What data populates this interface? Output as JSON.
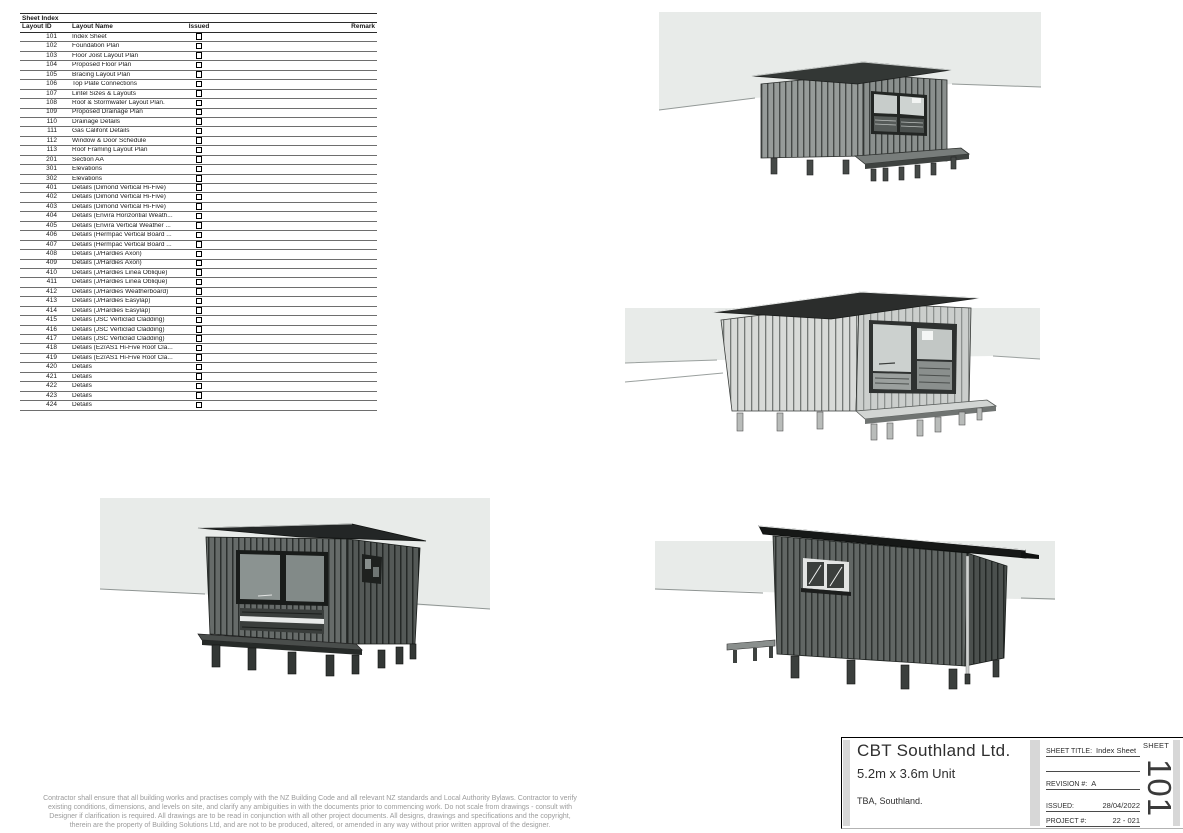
{
  "colors": {
    "sky_band": "#e8ebe9",
    "table_rule": "#6e6e6e",
    "divider_gray": "#d7d7d7",
    "disclaimer_text": "#9b9b9b",
    "ink": "#1a1a1a"
  },
  "sheet_index": {
    "title": "Sheet Index",
    "columns": [
      "Layout ID",
      "Layout Name",
      "Issued",
      "Remark"
    ],
    "rows": [
      {
        "layout_id": "101",
        "layout_name": "Index Sheet",
        "issued": false,
        "remark": ""
      },
      {
        "layout_id": "102",
        "layout_name": "Foundation Plan",
        "issued": false,
        "remark": ""
      },
      {
        "layout_id": "103",
        "layout_name": "Floor Joist Layout Plan",
        "issued": false,
        "remark": ""
      },
      {
        "layout_id": "104",
        "layout_name": "Proposed Floor Plan",
        "issued": false,
        "remark": ""
      },
      {
        "layout_id": "105",
        "layout_name": "Bracing Layout Plan",
        "issued": false,
        "remark": ""
      },
      {
        "layout_id": "106",
        "layout_name": "Top Plate Connections",
        "issued": false,
        "remark": ""
      },
      {
        "layout_id": "107",
        "layout_name": "Lintel Sizes & Layouts",
        "issued": false,
        "remark": ""
      },
      {
        "layout_id": "108",
        "layout_name": "Roof & Stormwater Layout Plan.",
        "issued": false,
        "remark": ""
      },
      {
        "layout_id": "109",
        "layout_name": "Proposed Drainage Plan",
        "issued": false,
        "remark": ""
      },
      {
        "layout_id": "110",
        "layout_name": "Drainage Details",
        "issued": false,
        "remark": ""
      },
      {
        "layout_id": "111",
        "layout_name": "Gas Califont Details",
        "issued": false,
        "remark": ""
      },
      {
        "layout_id": "112",
        "layout_name": "Window & Door Schedule",
        "issued": false,
        "remark": ""
      },
      {
        "layout_id": "113",
        "layout_name": "Roof Framing Layout Plan",
        "issued": false,
        "remark": ""
      },
      {
        "layout_id": "201",
        "layout_name": "Section AA",
        "issued": false,
        "remark": ""
      },
      {
        "layout_id": "301",
        "layout_name": "Elevations",
        "issued": false,
        "remark": ""
      },
      {
        "layout_id": "302",
        "layout_name": "Elevations",
        "issued": false,
        "remark": ""
      },
      {
        "layout_id": "401",
        "layout_name": "Details (Dimond Vertical Hi-Five)",
        "issued": false,
        "remark": ""
      },
      {
        "layout_id": "402",
        "layout_name": "Details (Dimond Vertical Hi-Five)",
        "issued": false,
        "remark": ""
      },
      {
        "layout_id": "403",
        "layout_name": "Details (Dimond Vertical Hi-Five)",
        "issued": false,
        "remark": ""
      },
      {
        "layout_id": "404",
        "layout_name": "Details (Envira Horizontial Weath...",
        "issued": false,
        "remark": ""
      },
      {
        "layout_id": "405",
        "layout_name": "Details (Envira Vertical Weather ...",
        "issued": false,
        "remark": ""
      },
      {
        "layout_id": "406",
        "layout_name": "Details (Hermpac Vertical Board ...",
        "issued": false,
        "remark": ""
      },
      {
        "layout_id": "407",
        "layout_name": "Details (Hermpac Vertical Board ...",
        "issued": false,
        "remark": ""
      },
      {
        "layout_id": "408",
        "layout_name": "Details (J/Hardies Axon)",
        "issued": false,
        "remark": ""
      },
      {
        "layout_id": "409",
        "layout_name": "Details (J/Hardies Axon)",
        "issued": false,
        "remark": ""
      },
      {
        "layout_id": "410",
        "layout_name": "Details (J/Hardies Linea Oblique)",
        "issued": false,
        "remark": ""
      },
      {
        "layout_id": "411",
        "layout_name": "Details (J/Hardies Linea Oblique)",
        "issued": false,
        "remark": ""
      },
      {
        "layout_id": "412",
        "layout_name": "Details (J/Hardies Weatherboard)",
        "issued": false,
        "remark": ""
      },
      {
        "layout_id": "413",
        "layout_name": "Details (J/Hardies Easylap)",
        "issued": false,
        "remark": ""
      },
      {
        "layout_id": "414",
        "layout_name": "Details (J/Hardies Easylap)",
        "issued": false,
        "remark": ""
      },
      {
        "layout_id": "415",
        "layout_name": "Details (JSC Verticlad Cladding)",
        "issued": false,
        "remark": ""
      },
      {
        "layout_id": "416",
        "layout_name": "Details (JSC Verticlad Cladding)",
        "issued": false,
        "remark": ""
      },
      {
        "layout_id": "417",
        "layout_name": "Details (JSC Verticlad Cladding)",
        "issued": false,
        "remark": ""
      },
      {
        "layout_id": "418",
        "layout_name": "Details (E2/AS1 Hi-Five Roof Cla...",
        "issued": false,
        "remark": ""
      },
      {
        "layout_id": "419",
        "layout_name": "Details (E2/AS1 Hi-Five Roof Cla...",
        "issued": false,
        "remark": ""
      },
      {
        "layout_id": "420",
        "layout_name": "Details",
        "issued": false,
        "remark": ""
      },
      {
        "layout_id": "421",
        "layout_name": "Details",
        "issued": false,
        "remark": ""
      },
      {
        "layout_id": "422",
        "layout_name": "Details",
        "issued": false,
        "remark": ""
      },
      {
        "layout_id": "423",
        "layout_name": "Details",
        "issued": false,
        "remark": ""
      },
      {
        "layout_id": "424",
        "layout_name": "Details",
        "issued": false,
        "remark": ""
      }
    ]
  },
  "disclaimer_lines": [
    "Contractor shall ensure that all building works and practises comply with the NZ Building Code and all relevant NZ standards and Local Authority Bylaws. Contractor to verify",
    "existing conditions, dimensions, and levels on site, and clarify any ambiguities in with the documents prior to commencing work. Do not scale from drawings - consult with",
    "Designer if clarification is required. All drawings are to be read in conjunction with all other project documents. All designs, drawings and specifications and the copyright,",
    "therein are the property of Building Solutions Ltd, and are not to be produced, altered, or amended in any way without prior written approval of the designer."
  ],
  "title_block": {
    "company": "CBT Southland Ltd.",
    "unit_size": "5.2m x 3.6m Unit",
    "location": "TBA, Southland.",
    "sheet_title_label": "SHEET TITLE:",
    "sheet_title_value": "Index Sheet",
    "sheet_word": "SHEET",
    "revision_label": "REVISION #:",
    "revision_value": "A",
    "issued_label": "ISSUED:",
    "issued_value": "28/04/2022",
    "project_label": "PROJECT #:",
    "project_value": "22 - 021",
    "sheet_number": "101"
  }
}
